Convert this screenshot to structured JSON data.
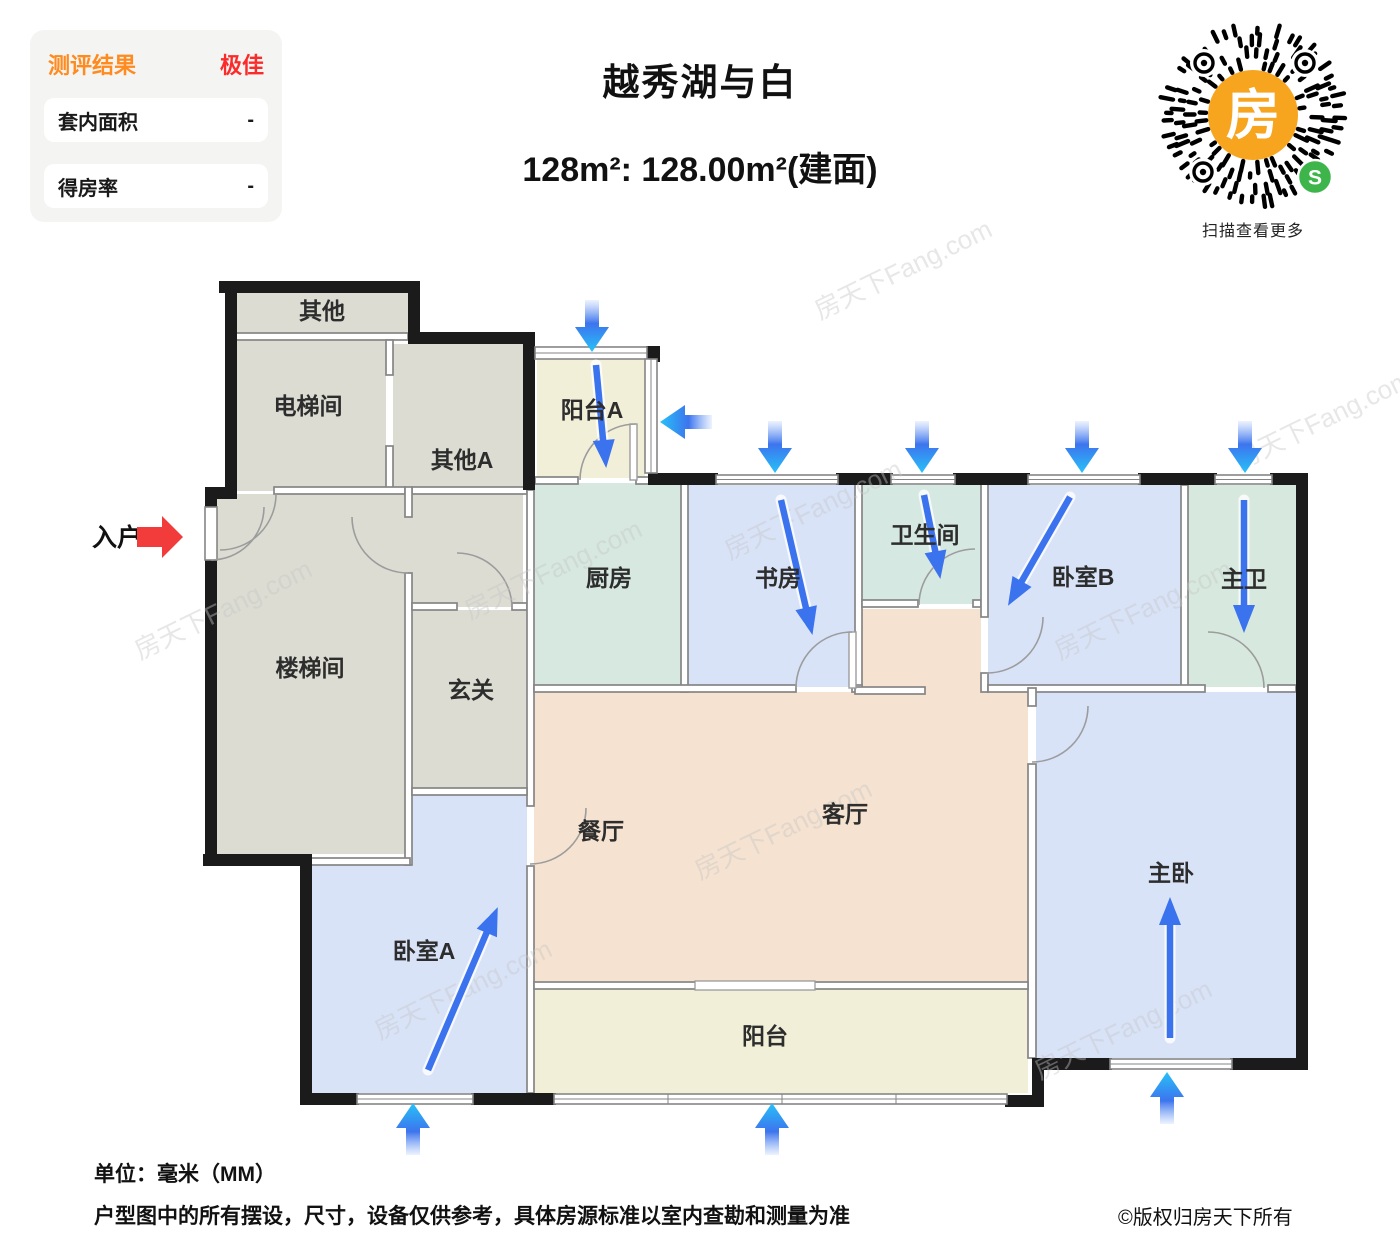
{
  "header": {
    "eval": {
      "title": "测评结果",
      "grade": "极佳",
      "rows": [
        {
          "label": "套内面积",
          "value": "-"
        },
        {
          "label": "得房率",
          "value": "-"
        }
      ]
    },
    "title": "越秀湖与白",
    "subtitle": "128m²: 128.00m²(建面)",
    "qr": {
      "center_char": "房",
      "badge_char": "S",
      "caption": "扫描查看更多"
    }
  },
  "plan": {
    "entry_label": "入户",
    "watermark": "房天下Fang.com",
    "rooms": [
      {
        "id": "other",
        "label": "其他"
      },
      {
        "id": "elevator-hall",
        "label": "电梯间"
      },
      {
        "id": "other-a",
        "label": "其他A"
      },
      {
        "id": "balcony-a",
        "label": "阳台A"
      },
      {
        "id": "stair-hall",
        "label": "楼梯间"
      },
      {
        "id": "foyer",
        "label": "玄关"
      },
      {
        "id": "kitchen",
        "label": "厨房"
      },
      {
        "id": "study",
        "label": "书房"
      },
      {
        "id": "bathroom",
        "label": "卫生间"
      },
      {
        "id": "bedroom-b",
        "label": "卧室B"
      },
      {
        "id": "master-bath",
        "label": "主卫"
      },
      {
        "id": "dining-room",
        "label": "餐厅"
      },
      {
        "id": "living-room",
        "label": "客厅"
      },
      {
        "id": "balcony",
        "label": "阳台"
      },
      {
        "id": "bedroom-a",
        "label": "卧室A"
      },
      {
        "id": "master-bedroom",
        "label": "主卧"
      }
    ]
  },
  "footer": {
    "unit": "单位：毫米（MM）",
    "disclaimer": "户型图中的所有摆设，尺寸，设备仅供参考，具体房源标准以室内查勘和测量为准",
    "copyright": "©版权归房天下所有"
  },
  "colors": {
    "accent_orange": "#ff8a1e",
    "accent_red": "#fb2b2b",
    "arrow_blue": "#3b72ee",
    "arrow_cyan": "#27c1f8",
    "entry_arrow_red": "#f23c3c",
    "qr_orange": "#f7a41f",
    "qr_green": "#3db54a",
    "room_gray": "#dcdcd3",
    "room_cream": "#f1efd8",
    "room_teal": "#d6e8e0",
    "room_blue": "#d8e3f8",
    "room_pink": "#f5e2d0",
    "wall_black": "#1b1b1b",
    "wall_gray": "#858585"
  }
}
